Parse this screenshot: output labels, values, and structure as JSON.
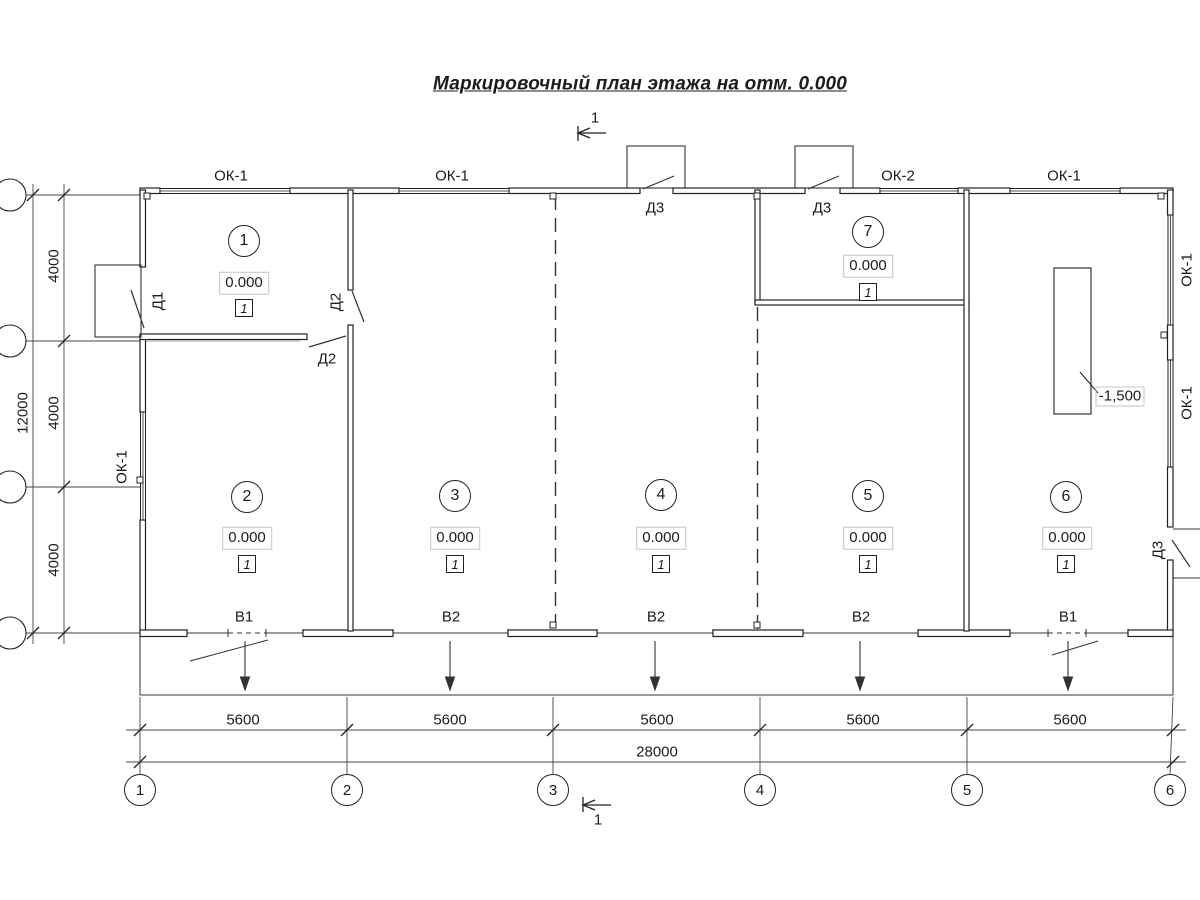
{
  "title": "Маркировочный план этажа на отм. 0.000",
  "section_marks": {
    "top": "1",
    "bottom": "1"
  },
  "windows": {
    "top": [
      "ОК-1",
      "ОК-1",
      "ОК-2",
      "ОК-1"
    ],
    "left": "ОК-1",
    "right": [
      "ОК-1",
      "ОК-1"
    ]
  },
  "doors": {
    "d1": "Д1",
    "d2_vertical": "Д2",
    "d2_horizontal": "Д2",
    "d3_top_left": "Д3",
    "d3_top_right": "Д3",
    "d3_right": "Д3"
  },
  "rooms": [
    {
      "number": "1",
      "elevation": "0.000",
      "finish": "1"
    },
    {
      "number": "2",
      "elevation": "0.000",
      "finish": "1"
    },
    {
      "number": "3",
      "elevation": "0.000",
      "finish": "1"
    },
    {
      "number": "4",
      "elevation": "0.000",
      "finish": "1"
    },
    {
      "number": "5",
      "elevation": "0.000",
      "finish": "1"
    },
    {
      "number": "6",
      "elevation": "0.000",
      "finish": "1"
    },
    {
      "number": "7",
      "elevation": "0.000",
      "finish": "1"
    }
  ],
  "pit": {
    "elevation": "-1,500"
  },
  "gates": [
    {
      "label": "В1"
    },
    {
      "label": "В2"
    },
    {
      "label": "В2"
    },
    {
      "label": "В2"
    },
    {
      "label": "В1"
    }
  ],
  "dimensions": {
    "bottom_bays": [
      "5600",
      "5600",
      "5600",
      "5600",
      "5600"
    ],
    "bottom_total": "28000",
    "left_bays": [
      "4000",
      "4000",
      "4000"
    ],
    "left_total": "12000"
  },
  "axes": {
    "bottom": [
      "1",
      "2",
      "3",
      "4",
      "5",
      "6"
    ]
  },
  "line_color": "#222222"
}
